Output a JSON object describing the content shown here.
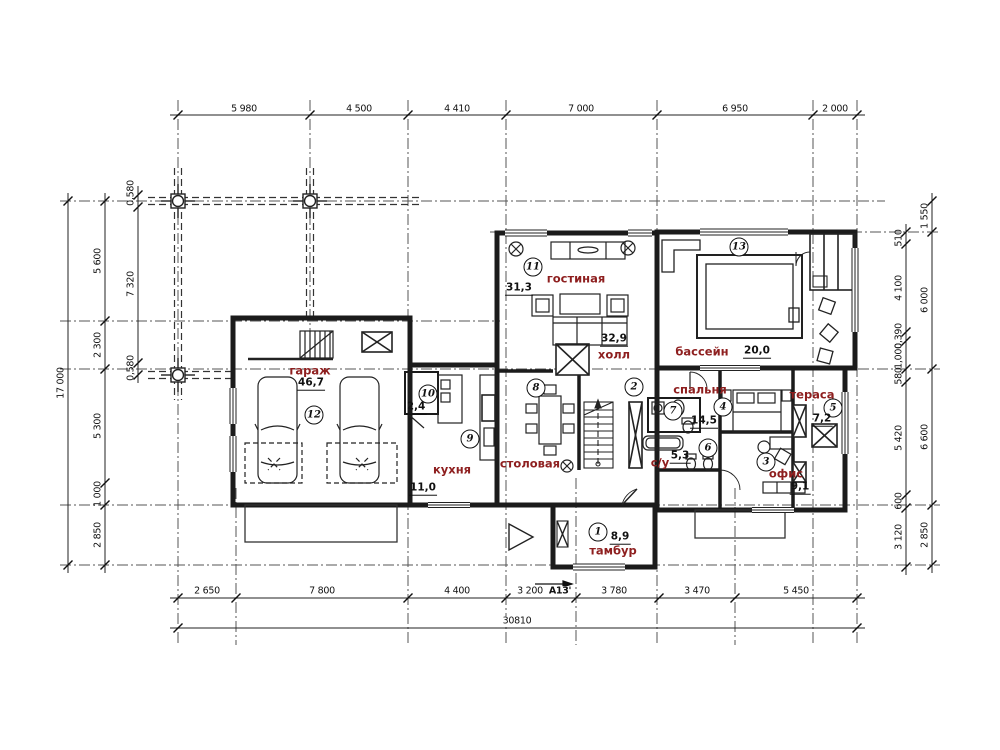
{
  "accent_color": "#8e1f1f",
  "drawing": {
    "type": "architectural floor plan",
    "language": "Russian"
  },
  "dims": {
    "top": [
      "5 980",
      "4 500",
      "4 410",
      "7 000",
      "6 950",
      "2 000"
    ],
    "bottom": [
      "2 650",
      "7 800",
      "4 400",
      "3 200",
      "3 780",
      "3 470",
      "5 450"
    ],
    "bottom_total": "30810",
    "left_outer": "17 000",
    "left_inner": [
      "5 600",
      "2 300",
      "5 300",
      "1 000",
      "2 850"
    ],
    "left_beam": [
      "0,580",
      "7 320",
      "0,580"
    ],
    "right_inner": [
      "510",
      "4 100",
      "0,390",
      "1,000",
      "580",
      "5 420",
      "600",
      "3 120"
    ],
    "right_outer": [
      "1 550",
      "6 000",
      "6 600",
      "2 850"
    ],
    "section_mark": "А13'"
  },
  "rooms": [
    {
      "num": "1",
      "name": "тамбур",
      "area": "8,9"
    },
    {
      "num": "2",
      "name": "холл",
      "area": "32,9"
    },
    {
      "num": "3",
      "name": "офис",
      "area": "9,1"
    },
    {
      "num": "4",
      "name": "спальня",
      "area": "14,5"
    },
    {
      "num": "5",
      "name": "тераса",
      "area": "7,2"
    },
    {
      "num": "6"
    },
    {
      "num": "7",
      "name": "с/у",
      "area": "5,3"
    },
    {
      "num": "8",
      "name": "столовая"
    },
    {
      "num": "9",
      "name": "кухня",
      "area": "11,0"
    },
    {
      "num": "10",
      "area": "2,4"
    },
    {
      "num": "11",
      "name": "гостиная",
      "area": "31,3"
    },
    {
      "num": "12",
      "name": "гараж",
      "area": "46,7"
    },
    {
      "num": "13",
      "name": "бассейн",
      "area": "20,0"
    }
  ]
}
